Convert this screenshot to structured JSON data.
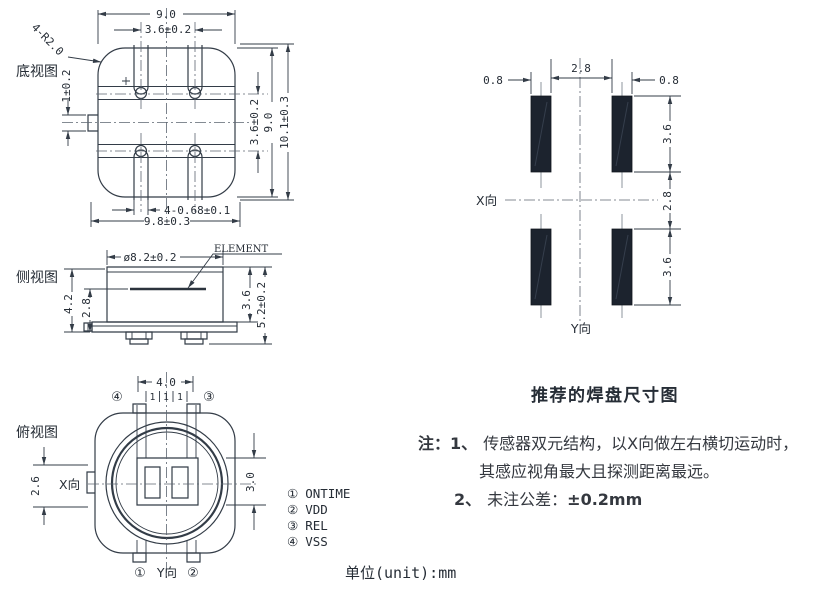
{
  "unit_label": "单位(unit):mm",
  "pad_section_title": "推荐的焊盘尺寸图",
  "notes": {
    "label": "注：",
    "n1_num": "1、",
    "n1_line1": "传感器双元结构，以X向做左右横切运动时，",
    "n1_line2": "其感应视角最大且探测距离最远。",
    "n2_num": "2、",
    "n2_text": "未注公差：",
    "n2_value": "±0.2mm"
  },
  "pin_list": {
    "items": [
      {
        "num": "①",
        "name": "ONTIME"
      },
      {
        "num": "②",
        "name": "VDD"
      },
      {
        "num": "③",
        "name": "REL"
      },
      {
        "num": "④",
        "name": "VSS"
      }
    ]
  },
  "views": {
    "bottom": {
      "label": "底视图",
      "dim_width": "9.0",
      "dim_slot_pitch": "3.6±0.2",
      "dim_corner": "4-R2.0",
      "dim_tab": "1±0.2",
      "dim_pitch_v": "3.6±0.2",
      "dim_height": "9.0",
      "dim_overall_h": "10.1±0.3",
      "dim_slot": "4-0.68±0.1",
      "dim_overall_w": "9.8±0.3"
    },
    "side": {
      "label": "侧视图",
      "dim_dia": "ø8.2±0.2",
      "element_label": "ELEMENT",
      "dim_42": "4.2",
      "dim_28": "2.8",
      "dim_36": "3.6",
      "dim_52": "5.2±0.2"
    },
    "top": {
      "label": "俯视图",
      "dim_40": "4.0",
      "dim_1a": "1",
      "dim_1b": "1",
      "dim_1c": "1",
      "dim_26": "2.6",
      "dim_30": "3.0",
      "x_axis": "X向",
      "y_axis": "Y向",
      "pin1": "①",
      "pin2": "②",
      "pin3": "③",
      "pin4": "④"
    },
    "pads": {
      "dim_left": "0.8",
      "dim_gap": "2.8",
      "dim_right": "0.8",
      "dim_t36": "3.6",
      "dim_m28": "2.8",
      "dim_b36": "3.6",
      "x_axis": "X向",
      "y_axis": "Y向"
    }
  },
  "colors": {
    "line": "#333c47",
    "text": "#262d36",
    "pad_fill": "#1c232e",
    "background": "#ffffff"
  }
}
